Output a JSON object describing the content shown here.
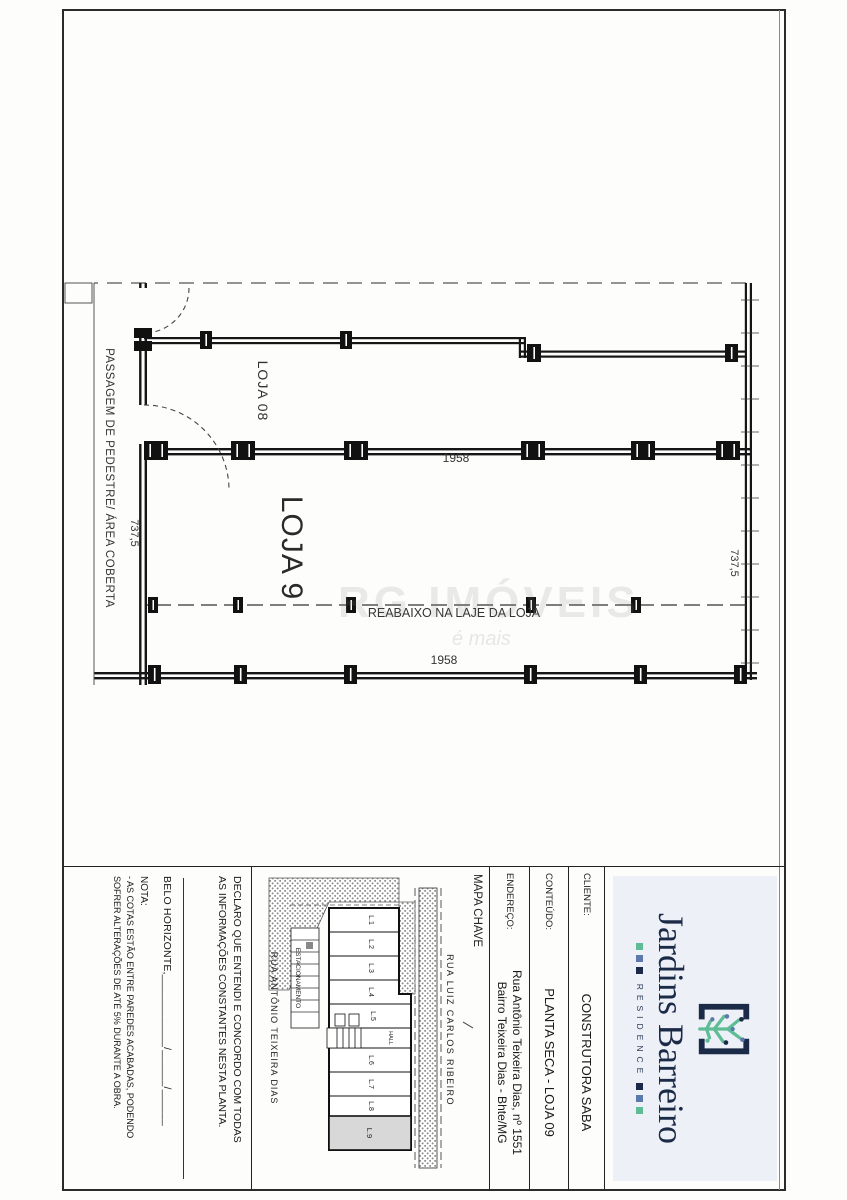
{
  "plan": {
    "labels": {
      "loja8": "LOJA 08",
      "loja9": "LOJA 9",
      "passage": "PASSAGEM DE PEDESTRE/ ÁREA COBERTA",
      "reabaixo": "REABAIXO NA LAJE DA LOJA"
    },
    "dimensions": {
      "depth_mid": "1958",
      "depth_right": "1958",
      "width_front": "737,5",
      "width_back": "737,5"
    }
  },
  "watermark": {
    "line1": "RG IMÓVEIS",
    "line2": "é mais"
  },
  "title_block": {
    "logo": {
      "name": "Jardins Barreiro",
      "subtitle": "RESIDENCE"
    },
    "cliente": {
      "label": "CLIENTE:",
      "value": "CONSTRUTORA SABA"
    },
    "conteudo": {
      "label": "CONTEÚDO:",
      "value": "PLANTA SECA - LOJA 09"
    },
    "endereco": {
      "label": "ENDEREÇO:",
      "line1": "Rua Antônio Teixeira Dias, nº 1551",
      "line2": "Bairro Teixeira Dias - Bhte/MG"
    },
    "mapa": {
      "label": "MAPA CHAVE",
      "street_top": "RUA LUIZ CARLOS RIBEIRO",
      "street_bottom": "RUA ANTÔNIO TEIXEIRA DIAS",
      "units": [
        "L.1",
        "L.2",
        "L.3",
        "L.4",
        "L.5",
        "L.6",
        "L.7",
        "L.8",
        "L.9"
      ],
      "hall": "HALL",
      "estacionamento": "ESTACIONAMENTO"
    },
    "declaration": {
      "line1": "DECLARO QUE ENTENDI E CONCORDO COM TODAS",
      "line2": "AS INFORMAÇÕES CONSTANTES NESTA PLANTA."
    },
    "date_line": "BELO HORIZONTE,____________/______/______",
    "nota": {
      "label": "NOTA:",
      "line1": "- AS COTAS ESTÃO ENTRE PAREDES ACABADAS, PODENDO",
      "line2": "SOFRER ALTERAÇÕES DE ATÉ 5% DURANTE A OBRA."
    }
  },
  "colors": {
    "navy": "#1b2a47",
    "blue": "#5b79ad",
    "green": "#5fbd96",
    "logo_bg": "#edf1f7",
    "unit9_fill": "#d8d8d8"
  }
}
